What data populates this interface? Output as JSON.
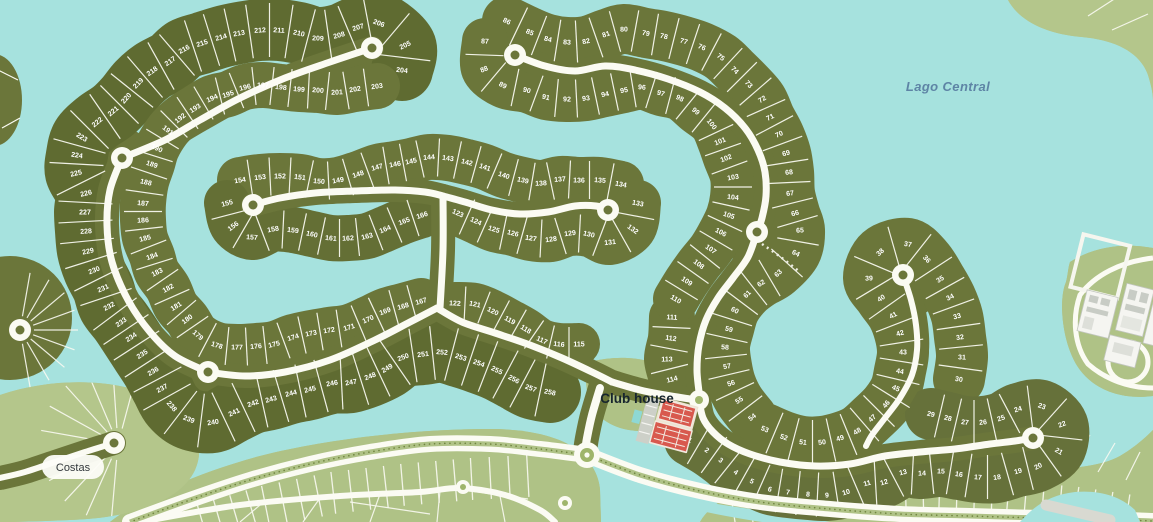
{
  "map_labels": {
    "lake": "Lago Central",
    "club_house": "Club house",
    "area": "Costas"
  },
  "colors": {
    "water": "#A6E2DE",
    "lot": "#6B763A",
    "lot_dark": "#5F6B31",
    "sage": "#AFC286",
    "road": "#FBFBF3",
    "court_red": "#D8594E",
    "building": "#F5F5F1",
    "lake_label": "#5E84A5"
  },
  "lot_rows": [
    {
      "name": "west-spiral-outer",
      "color": "#5F6B31",
      "width": 62,
      "lots": [
        [
          258,
          550,
          392
        ],
        [
          257,
          531,
          388
        ],
        [
          256,
          514,
          379
        ],
        [
          255,
          497,
          370
        ],
        [
          254,
          479,
          363
        ],
        [
          253,
          461,
          357
        ],
        [
          252,
          442,
          352
        ],
        [
          251,
          423,
          354
        ],
        [
          250,
          403,
          357
        ],
        [
          249,
          387,
          368
        ],
        [
          248,
          370,
          376
        ],
        [
          247,
          351,
          382
        ],
        [
          246,
          332,
          383
        ],
        [
          245,
          310,
          389
        ],
        [
          244,
          291,
          393
        ],
        [
          243,
          271,
          399
        ],
        [
          242,
          253,
          403
        ],
        [
          241,
          234,
          412
        ],
        [
          240,
          213,
          422
        ],
        [
          239,
          189,
          419
        ],
        [
          238,
          172,
          406
        ],
        [
          237,
          162,
          388
        ],
        [
          236,
          153,
          371
        ],
        [
          235,
          142,
          354
        ],
        [
          234,
          131,
          337
        ],
        [
          233,
          121,
          322
        ],
        [
          232,
          109,
          306
        ],
        [
          231,
          103,
          288
        ],
        [
          230,
          94,
          270
        ],
        [
          229,
          88,
          251
        ],
        [
          228,
          86,
          231
        ],
        [
          227,
          85,
          212
        ],
        [
          226,
          86,
          193
        ],
        [
          225,
          76,
          173
        ],
        [
          224,
          77,
          155
        ],
        [
          223,
          82,
          137
        ],
        [
          222,
          97,
          122
        ],
        [
          221,
          113,
          111
        ],
        [
          220,
          126,
          98
        ],
        [
          219,
          138,
          83
        ],
        [
          218,
          152,
          71
        ],
        [
          217,
          170,
          61
        ],
        [
          216,
          184,
          49
        ],
        [
          215,
          202,
          43
        ],
        [
          214,
          221,
          37
        ],
        [
          213,
          239,
          33
        ],
        [
          212,
          260,
          30
        ],
        [
          211,
          279,
          30
        ],
        [
          210,
          299,
          33
        ],
        [
          209,
          318,
          38
        ],
        [
          208,
          339,
          35
        ],
        [
          207,
          358,
          27
        ],
        [
          206,
          379,
          23
        ],
        [
          205,
          405,
          45
        ],
        [
          204,
          402,
          70
        ]
      ]
    },
    {
      "name": "west-spiral-inner",
      "color": "#6B763A",
      "width": 46,
      "lots": [
        [
          167,
          421,
          301
        ],
        [
          168,
          403,
          306
        ],
        [
          169,
          385,
          311
        ],
        [
          170,
          368,
          319
        ],
        [
          171,
          349,
          327
        ],
        [
          172,
          329,
          330
        ],
        [
          173,
          311,
          333
        ],
        [
          174,
          293,
          337
        ],
        [
          175,
          274,
          344
        ],
        [
          176,
          256,
          346
        ],
        [
          177,
          237,
          347
        ],
        [
          178,
          217,
          345
        ],
        [
          179,
          198,
          335
        ],
        [
          180,
          187,
          319
        ],
        [
          181,
          176,
          306
        ],
        [
          182,
          168,
          288
        ],
        [
          183,
          157,
          272
        ],
        [
          184,
          152,
          256
        ],
        [
          185,
          145,
          238
        ],
        [
          186,
          143,
          220
        ],
        [
          187,
          143,
          203
        ],
        [
          188,
          146,
          182
        ],
        [
          189,
          152,
          164
        ],
        [
          190,
          157,
          148
        ],
        [
          191,
          168,
          130
        ],
        [
          192,
          180,
          118
        ],
        [
          193,
          195,
          108
        ],
        [
          194,
          212,
          98
        ],
        [
          195,
          228,
          94
        ],
        [
          196,
          245,
          87
        ],
        [
          197,
          263,
          85
        ],
        [
          198,
          281,
          87
        ],
        [
          199,
          299,
          89
        ],
        [
          200,
          318,
          90
        ],
        [
          201,
          337,
          92
        ],
        [
          202,
          355,
          89
        ],
        [
          203,
          377,
          86
        ]
      ]
    },
    {
      "name": "mid-snake-north",
      "color": "#6B763A",
      "width": 46,
      "lots": [
        [
          154,
          240,
          180
        ],
        [
          153,
          260,
          177
        ],
        [
          152,
          280,
          176
        ],
        [
          151,
          300,
          177
        ],
        [
          150,
          319,
          181
        ],
        [
          149,
          338,
          180
        ],
        [
          148,
          358,
          174
        ],
        [
          147,
          377,
          167
        ],
        [
          146,
          395,
          164
        ],
        [
          145,
          411,
          161
        ],
        [
          144,
          429,
          157
        ],
        [
          143,
          448,
          158
        ],
        [
          142,
          467,
          162
        ],
        [
          141,
          485,
          167
        ],
        [
          140,
          504,
          175
        ],
        [
          139,
          523,
          180
        ],
        [
          138,
          541,
          183
        ],
        [
          137,
          560,
          179
        ],
        [
          136,
          579,
          180
        ],
        [
          135,
          600,
          180
        ],
        [
          134,
          621,
          184
        ]
      ]
    },
    {
      "name": "mid-snake-south-west",
      "color": "#646F35",
      "width": 46,
      "lots": [
        [
          155,
          227,
          203
        ],
        [
          156,
          233,
          226
        ],
        [
          157,
          252,
          237
        ],
        [
          158,
          273,
          229
        ],
        [
          159,
          293,
          230
        ],
        [
          160,
          312,
          234
        ],
        [
          161,
          331,
          238
        ],
        [
          162,
          348,
          238
        ],
        [
          163,
          367,
          236
        ],
        [
          164,
          385,
          229
        ],
        [
          165,
          404,
          221
        ],
        [
          166,
          422,
          215
        ]
      ]
    },
    {
      "name": "mid-snake-south-east",
      "color": "#6B763A",
      "width": 46,
      "lots": [
        [
          123,
          458,
          213
        ],
        [
          124,
          476,
          221
        ],
        [
          125,
          494,
          229
        ],
        [
          126,
          513,
          233
        ],
        [
          127,
          531,
          238
        ],
        [
          128,
          551,
          239
        ],
        [
          129,
          570,
          233
        ],
        [
          130,
          589,
          234
        ],
        [
          131,
          610,
          242
        ],
        [
          132,
          633,
          229
        ],
        [
          133,
          638,
          203
        ]
      ]
    },
    {
      "name": "clubhouse-north-row",
      "color": "#6B763A",
      "width": 42,
      "lots": [
        [
          122,
          455,
          303
        ],
        [
          121,
          475,
          304
        ],
        [
          120,
          493,
          311
        ],
        [
          119,
          510,
          320
        ],
        [
          118,
          526,
          329
        ],
        [
          117,
          542,
          340
        ],
        [
          116,
          559,
          344
        ],
        [
          115,
          579,
          344
        ]
      ]
    },
    {
      "name": "clubhouse-east-column",
      "color": "#6B763A",
      "width": 46,
      "lots": [
        [
          111,
          672,
          317
        ],
        [
          112,
          671,
          338
        ],
        [
          113,
          667,
          359
        ],
        [
          114,
          672,
          379
        ]
      ]
    },
    {
      "name": "east-snake-outer",
      "color": "#6B763A",
      "width": 50,
      "lots": [
        [
          86,
          507,
          21
        ],
        [
          85,
          530,
          32
        ],
        [
          84,
          548,
          39
        ],
        [
          83,
          567,
          42
        ],
        [
          82,
          586,
          41
        ],
        [
          81,
          606,
          34
        ],
        [
          80,
          624,
          29
        ],
        [
          79,
          646,
          33
        ],
        [
          78,
          664,
          36
        ],
        [
          77,
          684,
          41
        ],
        [
          76,
          702,
          47
        ],
        [
          75,
          721,
          57
        ],
        [
          74,
          735,
          70
        ],
        [
          73,
          749,
          84
        ],
        [
          72,
          762,
          99
        ],
        [
          71,
          770,
          117
        ],
        [
          70,
          779,
          134
        ],
        [
          69,
          786,
          153
        ],
        [
          68,
          789,
          172
        ],
        [
          67,
          790,
          193
        ],
        [
          66,
          795,
          213
        ],
        [
          65,
          800,
          230
        ],
        [
          64,
          796,
          253
        ],
        [
          63,
          778,
          273
        ],
        [
          62,
          761,
          283
        ],
        [
          61,
          747,
          294
        ],
        [
          60,
          735,
          310
        ],
        [
          59,
          729,
          329
        ],
        [
          58,
          725,
          347
        ],
        [
          57,
          727,
          366
        ],
        [
          56,
          731,
          383
        ],
        [
          55,
          739,
          400
        ],
        [
          54,
          752,
          417
        ]
      ]
    },
    {
      "name": "east-snake-inner",
      "color": "#6B763A",
      "width": 46,
      "lots": [
        [
          87,
          485,
          41
        ],
        [
          88,
          484,
          69
        ],
        [
          89,
          503,
          85
        ],
        [
          90,
          527,
          90
        ],
        [
          91,
          546,
          97
        ],
        [
          92,
          567,
          99
        ],
        [
          93,
          586,
          98
        ],
        [
          94,
          605,
          94
        ],
        [
          95,
          624,
          90
        ],
        [
          96,
          642,
          87
        ],
        [
          97,
          661,
          93
        ],
        [
          98,
          680,
          98
        ],
        [
          99,
          696,
          111
        ],
        [
          100,
          712,
          124
        ],
        [
          101,
          720,
          141
        ],
        [
          102,
          726,
          158
        ],
        [
          103,
          733,
          177
        ],
        [
          104,
          733,
          197
        ],
        [
          105,
          729,
          215
        ],
        [
          106,
          721,
          232
        ],
        [
          107,
          711,
          249
        ],
        [
          108,
          699,
          264
        ],
        [
          109,
          687,
          281
        ],
        [
          110,
          676,
          299
        ]
      ]
    },
    {
      "name": "southeast-wrap",
      "color": "#6B763A",
      "width": 52,
      "lots": [
        [
          53,
          765,
          429
        ],
        [
          52,
          784,
          437
        ],
        [
          51,
          803,
          442
        ],
        [
          50,
          822,
          442
        ],
        [
          49,
          840,
          438
        ],
        [
          48,
          857,
          431
        ],
        [
          47,
          872,
          418
        ],
        [
          46,
          886,
          404
        ],
        [
          45,
          896,
          388
        ],
        [
          44,
          900,
          371
        ],
        [
          43,
          903,
          352
        ],
        [
          42,
          900,
          333
        ],
        [
          41,
          893,
          315
        ],
        [
          40,
          881,
          298
        ],
        [
          39,
          869,
          278
        ],
        [
          38,
          880,
          252
        ],
        [
          37,
          908,
          244
        ],
        [
          36,
          927,
          259
        ],
        [
          35,
          940,
          279
        ],
        [
          34,
          950,
          297
        ],
        [
          33,
          957,
          316
        ],
        [
          32,
          960,
          337
        ],
        [
          31,
          962,
          357
        ],
        [
          30,
          959,
          379
        ]
      ]
    },
    {
      "name": "south-arc",
      "color": "#66713A",
      "width": 52,
      "lots": [
        [
          1,
          690,
          440
        ],
        [
          2,
          707,
          450
        ],
        [
          3,
          721,
          460
        ],
        [
          4,
          736,
          472
        ],
        [
          5,
          752,
          481
        ],
        [
          6,
          770,
          489
        ],
        [
          7,
          788,
          492
        ],
        [
          8,
          808,
          494
        ],
        [
          9,
          827,
          495
        ],
        [
          10,
          846,
          492
        ],
        [
          11,
          867,
          483
        ],
        [
          12,
          884,
          482
        ],
        [
          13,
          903,
          472
        ],
        [
          14,
          922,
          473
        ],
        [
          15,
          941,
          471
        ],
        [
          16,
          959,
          474
        ],
        [
          17,
          978,
          477
        ],
        [
          18,
          997,
          477
        ],
        [
          19,
          1018,
          471
        ],
        [
          20,
          1038,
          466
        ],
        [
          21,
          1059,
          451
        ],
        [
          22,
          1062,
          424
        ],
        [
          23,
          1042,
          406
        ],
        [
          24,
          1018,
          409
        ],
        [
          25,
          1001,
          418
        ],
        [
          26,
          983,
          422
        ],
        [
          27,
          965,
          422
        ],
        [
          28,
          948,
          418
        ],
        [
          29,
          931,
          414
        ]
      ]
    }
  ]
}
